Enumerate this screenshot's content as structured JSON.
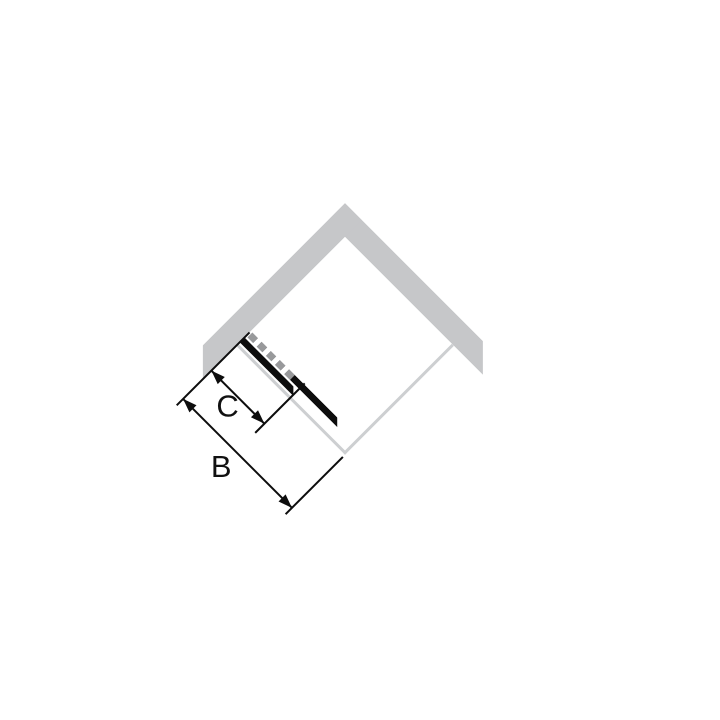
{
  "diagram": {
    "labels": {
      "b": "B",
      "c": "C"
    },
    "colors": {
      "background": "#ffffff",
      "wall": "#c6c7c9",
      "glass_panel": "#cdcfd1",
      "door_panel": "#0d0d0d",
      "hidden_door_dash": "#98999b",
      "dimension_line": "#0d0d0d"
    }
  }
}
